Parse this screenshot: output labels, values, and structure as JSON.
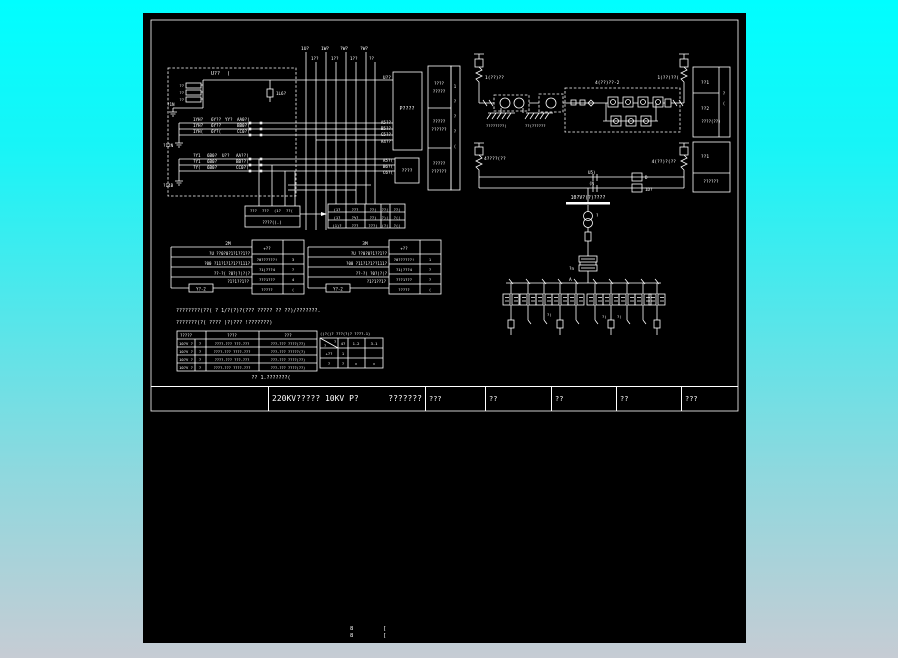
{
  "title_bar": {
    "main": "220KV????? 10KV P?",
    "sub": "???????",
    "cells": [
      "???",
      "??",
      "??",
      "??",
      "???"
    ]
  },
  "colors": {
    "background_top": "#00feff",
    "background_bottom": "#c6ccd4",
    "canvas": "#000000",
    "line": "#ffffff",
    "junction_dot": "#00b400"
  },
  "labels": [
    [
      68,
      62,
      "U??",
      5
    ],
    [
      84,
      62,
      "(",
      5
    ],
    [
      133,
      82,
      "1L6?",
      4.2
    ],
    [
      248,
      66,
      "U??",
      4.5,
      "end"
    ],
    [
      41,
      74,
      "??",
      3.8,
      "end"
    ],
    [
      41,
      81,
      "??",
      3.8,
      "end"
    ],
    [
      41,
      88,
      "??",
      3.8,
      "end"
    ],
    [
      24,
      93,
      "?1N",
      4.2
    ],
    [
      20,
      134,
      "?12N",
      4.2
    ],
    [
      20,
      174,
      "?14B",
      4.2
    ],
    [
      50,
      108,
      "1YH?",
      4.2
    ],
    [
      68,
      108,
      "6Y??",
      4.2
    ],
    [
      82,
      108,
      "YY?",
      4.2
    ],
    [
      94,
      108,
      "AA0?(",
      4.2
    ],
    [
      50,
      114,
      "1YH?",
      4.2
    ],
    [
      68,
      114,
      "6Y??",
      4.2
    ],
    [
      94,
      114,
      "BB0?(",
      4.2
    ],
    [
      50,
      120,
      "1YH(",
      4.2
    ],
    [
      68,
      120,
      "6Y?(",
      4.2
    ],
    [
      94,
      120,
      "CC0?(",
      4.2
    ],
    [
      50,
      144,
      "?Y1",
      4.2
    ],
    [
      64,
      144,
      "6B0?",
      4.2
    ],
    [
      79,
      144,
      "U??",
      4.2
    ],
    [
      93,
      144,
      "AA??(",
      4.2
    ],
    [
      50,
      150,
      "?Y1",
      4.2
    ],
    [
      64,
      150,
      "6B0?",
      4.2
    ],
    [
      93,
      150,
      "BB??(",
      4.2
    ],
    [
      50,
      156,
      "?Y(",
      4.2
    ],
    [
      64,
      156,
      "6B0?",
      4.2
    ],
    [
      93,
      156,
      "CC0?(",
      4.2
    ],
    [
      158,
      37,
      "1U?",
      4.5
    ],
    [
      178,
      37,
      "1W?",
      4.5
    ],
    [
      197,
      37,
      "?W?",
      4.5
    ],
    [
      217,
      37,
      "?W?",
      4.5
    ],
    [
      168,
      47,
      "1??",
      4.2
    ],
    [
      188,
      47,
      "1??",
      4.2
    ],
    [
      207,
      47,
      "1??",
      4.2
    ],
    [
      226,
      47,
      "??",
      4.2
    ],
    [
      248,
      111,
      "A5??",
      4.2,
      "end"
    ],
    [
      248,
      117,
      "B5??",
      4.2,
      "end"
    ],
    [
      248,
      123,
      "C5??",
      4.2,
      "end"
    ],
    [
      248,
      130,
      "A4??",
      4.2,
      "end"
    ],
    [
      250,
      149,
      "A5?(",
      4.2,
      "end"
    ],
    [
      250,
      155,
      "B6?(",
      4.2,
      "end"
    ],
    [
      250,
      161,
      "C6?(",
      4.2,
      "end"
    ],
    [
      264,
      97,
      "P????",
      5,
      "middle"
    ],
    [
      264,
      159,
      "????",
      4.5,
      "middle"
    ],
    [
      296,
      72,
      "????",
      4.2,
      "middle"
    ],
    [
      296,
      80,
      "?????",
      4.2,
      "middle"
    ],
    [
      296,
      110,
      "?????",
      4.2,
      "middle"
    ],
    [
      296,
      118,
      "??????",
      4.2,
      "middle"
    ],
    [
      296,
      152,
      "?????",
      4.2,
      "middle"
    ],
    [
      296,
      160,
      "??????",
      4.2,
      "middle"
    ],
    [
      312,
      75,
      "1",
      4,
      "middle"
    ],
    [
      312,
      90,
      "?",
      4,
      "middle"
    ],
    [
      312,
      105,
      "?",
      4,
      "middle"
    ],
    [
      312,
      120,
      "?",
      4,
      "middle"
    ],
    [
      312,
      135,
      "(",
      4,
      "middle"
    ],
    [
      342,
      66,
      "1(??)??",
      4.5
    ],
    [
      536,
      66,
      "1(??)??(",
      4.5,
      "end"
    ],
    [
      452,
      71,
      "4(??)??-2",
      4.5
    ],
    [
      343,
      114,
      "????????(",
      3.8
    ],
    [
      382,
      114,
      "??(??????",
      3.8
    ],
    [
      562,
      71,
      "??1",
      4.5,
      "middle"
    ],
    [
      562,
      97,
      "??2",
      4.5,
      "middle"
    ],
    [
      568,
      110,
      "????(??)",
      4,
      "middle"
    ],
    [
      581,
      82,
      "?",
      4,
      "middle"
    ],
    [
      581,
      92,
      "(",
      4,
      "middle"
    ],
    [
      562,
      145,
      "??1",
      4.5,
      "middle"
    ],
    [
      568,
      170,
      "??????",
      4.2,
      "middle"
    ],
    [
      341,
      147,
      "4????(??",
      4.5
    ],
    [
      533,
      150,
      "4(??)?(??",
      4.5,
      "end"
    ],
    [
      445,
      161,
      "U5)",
      4.2
    ],
    [
      446,
      172,
      "(N",
      4.2
    ],
    [
      502,
      166,
      "D",
      4.2
    ],
    [
      502,
      178,
      "1D?",
      4.2
    ],
    [
      445,
      186,
      "10?V?(?)????",
      4.8,
      "middle"
    ],
    [
      453,
      204,
      "?",
      4
    ],
    [
      431,
      257,
      "?n",
      4.2,
      "end"
    ],
    [
      426,
      268,
      "A",
      4.5
    ],
    [
      404,
      303,
      "?(",
      3.8
    ],
    [
      459,
      305,
      "?)",
      3.8
    ],
    [
      474,
      305,
      "?(",
      3.8
    ],
    [
      85,
      232,
      "2M",
      4.5,
      "middle"
    ],
    [
      107,
      242,
      "?U ??0?0?1?1??1??",
      4,
      "end"
    ],
    [
      107,
      252,
      "?00 ?11?1?1?1??111?",
      4,
      "end"
    ],
    [
      107,
      262,
      "??-?( ?0?)?)?(?",
      4,
      "end"
    ],
    [
      106,
      270,
      "?1?1??1??",
      4,
      "end"
    ],
    [
      58,
      277.5,
      "Y?-2",
      4,
      "middle"
    ],
    [
      124,
      237,
      "+??",
      4,
      "middle"
    ],
    [
      124,
      248,
      "?0??????!",
      3.8,
      "middle"
    ],
    [
      124,
      258,
      "?1)???4",
      3.8,
      "middle"
    ],
    [
      124,
      268,
      "???1???",
      3.8,
      "middle"
    ],
    [
      124,
      278,
      "?????",
      3.8,
      "middle"
    ],
    [
      150,
      248,
      "3",
      3.8,
      "middle"
    ],
    [
      150,
      258,
      "?",
      3.8,
      "middle"
    ],
    [
      150,
      268,
      "4",
      3.8,
      "middle"
    ],
    [
      150,
      278,
      "(",
      3.8,
      "middle"
    ],
    [
      222,
      232,
      "3M",
      4.5,
      "middle"
    ],
    [
      244,
      242,
      "?U ??0?0?1??1??",
      4,
      "end"
    ],
    [
      244,
      252,
      "?00 ?11?1?1??111?",
      4,
      "end"
    ],
    [
      244,
      262,
      "??-?( ?0?)?(?",
      4,
      "end"
    ],
    [
      243,
      270,
      "?1?1??1?",
      4,
      "end"
    ],
    [
      195,
      277.5,
      "Y?-2",
      4,
      "middle"
    ],
    [
      261,
      237,
      "+??",
      4,
      "middle"
    ],
    [
      261,
      248,
      "?0??????!",
      3.8,
      "middle"
    ],
    [
      261,
      258,
      "?1)???4",
      3.8,
      "middle"
    ],
    [
      261,
      268,
      "???1???",
      3.8,
      "middle"
    ],
    [
      261,
      278,
      "?????",
      3.8,
      "middle"
    ],
    [
      287,
      248,
      "1",
      3.8,
      "middle"
    ],
    [
      287,
      258,
      "?",
      3.8,
      "middle"
    ],
    [
      287,
      268,
      "?",
      3.8,
      "middle"
    ],
    [
      287,
      278,
      "(",
      3.8,
      "middle"
    ],
    [
      107,
      199,
      "???",
      3.8
    ],
    [
      119,
      199,
      "???",
      3.8
    ],
    [
      131,
      199,
      "(1?",
      3.8
    ],
    [
      143,
      199,
      "??(",
      3.8
    ],
    [
      129,
      211,
      "????((.)",
      4,
      "middle"
    ],
    [
      194,
      198,
      "(1?",
      3.8,
      "middle"
    ],
    [
      212,
      198,
      "???",
      3.8,
      "middle"
    ],
    [
      230,
      198,
      "??(",
      3.8,
      "middle"
    ],
    [
      242,
      198,
      "??(",
      3.8,
      "middle"
    ],
    [
      254,
      198,
      "??(",
      3.8,
      "middle"
    ],
    [
      194,
      206,
      "(1?",
      3.8,
      "middle"
    ],
    [
      212,
      206,
      "?%?",
      3.8,
      "middle"
    ],
    [
      230,
      206,
      "??)",
      3.8,
      "middle"
    ],
    [
      242,
      206,
      "?)(",
      3.8,
      "middle"
    ],
    [
      254,
      206,
      "?((",
      3.8,
      "middle"
    ],
    [
      194,
      214,
      "(1)?",
      3.8,
      "middle"
    ],
    [
      212,
      214,
      "???",
      3.8,
      "middle"
    ],
    [
      230,
      214,
      "???(",
      3.8,
      "middle"
    ],
    [
      242,
      214,
      "(?(",
      3.8,
      "middle"
    ],
    [
      254,
      214,
      "?((",
      3.8,
      "middle"
    ],
    [
      33,
      299,
      "????????(??( ? 1/?(?)?(??? ????? ?? ??)/???????.",
      5
    ],
    [
      33,
      311,
      "???????(?( ???? )?)??? !???????)",
      5
    ],
    [
      128,
      366,
      "?? 1.???????(",
      5,
      "middle"
    ],
    [
      43,
      324,
      "?????",
      4,
      "middle"
    ],
    [
      89,
      324,
      "????",
      4,
      "middle"
    ],
    [
      145,
      324,
      "???",
      4,
      "middle"
    ],
    [
      43,
      332,
      "10?V ?",
      3.8,
      "middle"
    ],
    [
      57,
      332,
      "?",
      3.8,
      "middle"
    ],
    [
      89,
      332,
      "????-??? ???-???",
      3.6,
      "middle"
    ],
    [
      145,
      332,
      "???-??? ????(??)",
      3.6,
      "middle"
    ],
    [
      43,
      340,
      "10?V ?",
      3.8,
      "middle"
    ],
    [
      57,
      340,
      "?",
      3.8,
      "middle"
    ],
    [
      89,
      340,
      "????-??? ????-???",
      3.6,
      "middle"
    ],
    [
      145,
      340,
      "???-??? ?????(?)",
      3.6,
      "middle"
    ],
    [
      43,
      348,
      "10?V ?",
      3.8,
      "middle"
    ],
    [
      57,
      348,
      "?",
      3.8,
      "middle"
    ],
    [
      89,
      348,
      "????-??? ???-???",
      3.6,
      "middle"
    ],
    [
      145,
      348,
      "???-??? ????(??)",
      3.6,
      "middle"
    ],
    [
      43,
      356,
      "10?V ?",
      3.8,
      "middle"
    ],
    [
      57,
      356,
      "?",
      3.8,
      "middle"
    ],
    [
      89,
      356,
      "????-??? ????-???",
      3.6,
      "middle"
    ],
    [
      145,
      356,
      "???-??? ????(??)",
      3.6,
      "middle"
    ],
    [
      177,
      322,
      "()?()? ???(?(? ????-1)",
      3.8
    ],
    [
      191,
      330,
      "?",
      3.6
    ],
    [
      181,
      334,
      "?",
      3.6
    ],
    [
      200,
      332,
      "4?",
      3.8,
      "middle"
    ],
    [
      213,
      332,
      "1-2",
      3.8,
      "middle"
    ],
    [
      231,
      332,
      "3-1",
      3.8,
      "middle"
    ],
    [
      186,
      342,
      "+??",
      3.8,
      "middle"
    ],
    [
      200,
      342,
      "1",
      3.8,
      "middle"
    ],
    [
      186,
      352,
      "?",
      3.8,
      "middle"
    ],
    [
      200,
      352,
      "?",
      3.8,
      "middle"
    ],
    [
      213,
      352,
      "×",
      3.8,
      "middle"
    ],
    [
      231,
      352,
      "×",
      3.8,
      "middle"
    ],
    [
      207,
      617,
      "8",
      5.5
    ],
    [
      207,
      624,
      "8",
      5.5
    ],
    [
      240,
      617,
      "[",
      5.5
    ],
    [
      240,
      624,
      "[",
      5.5
    ]
  ],
  "junction_dots": [
    [
      107,
      110
    ],
    [
      118,
      110
    ],
    [
      107,
      116
    ],
    [
      118,
      116
    ],
    [
      107,
      122
    ],
    [
      118,
      122
    ],
    [
      107,
      146
    ],
    [
      118,
      146
    ],
    [
      107,
      152
    ],
    [
      118,
      152
    ],
    [
      107,
      158
    ],
    [
      118,
      158
    ]
  ],
  "branches": {
    "baseline_y": 270,
    "xs": [
      368,
      385,
      401,
      417,
      433,
      452,
      468,
      484,
      500,
      514
    ],
    "big": [
      0,
      3,
      6,
      9
    ]
  }
}
